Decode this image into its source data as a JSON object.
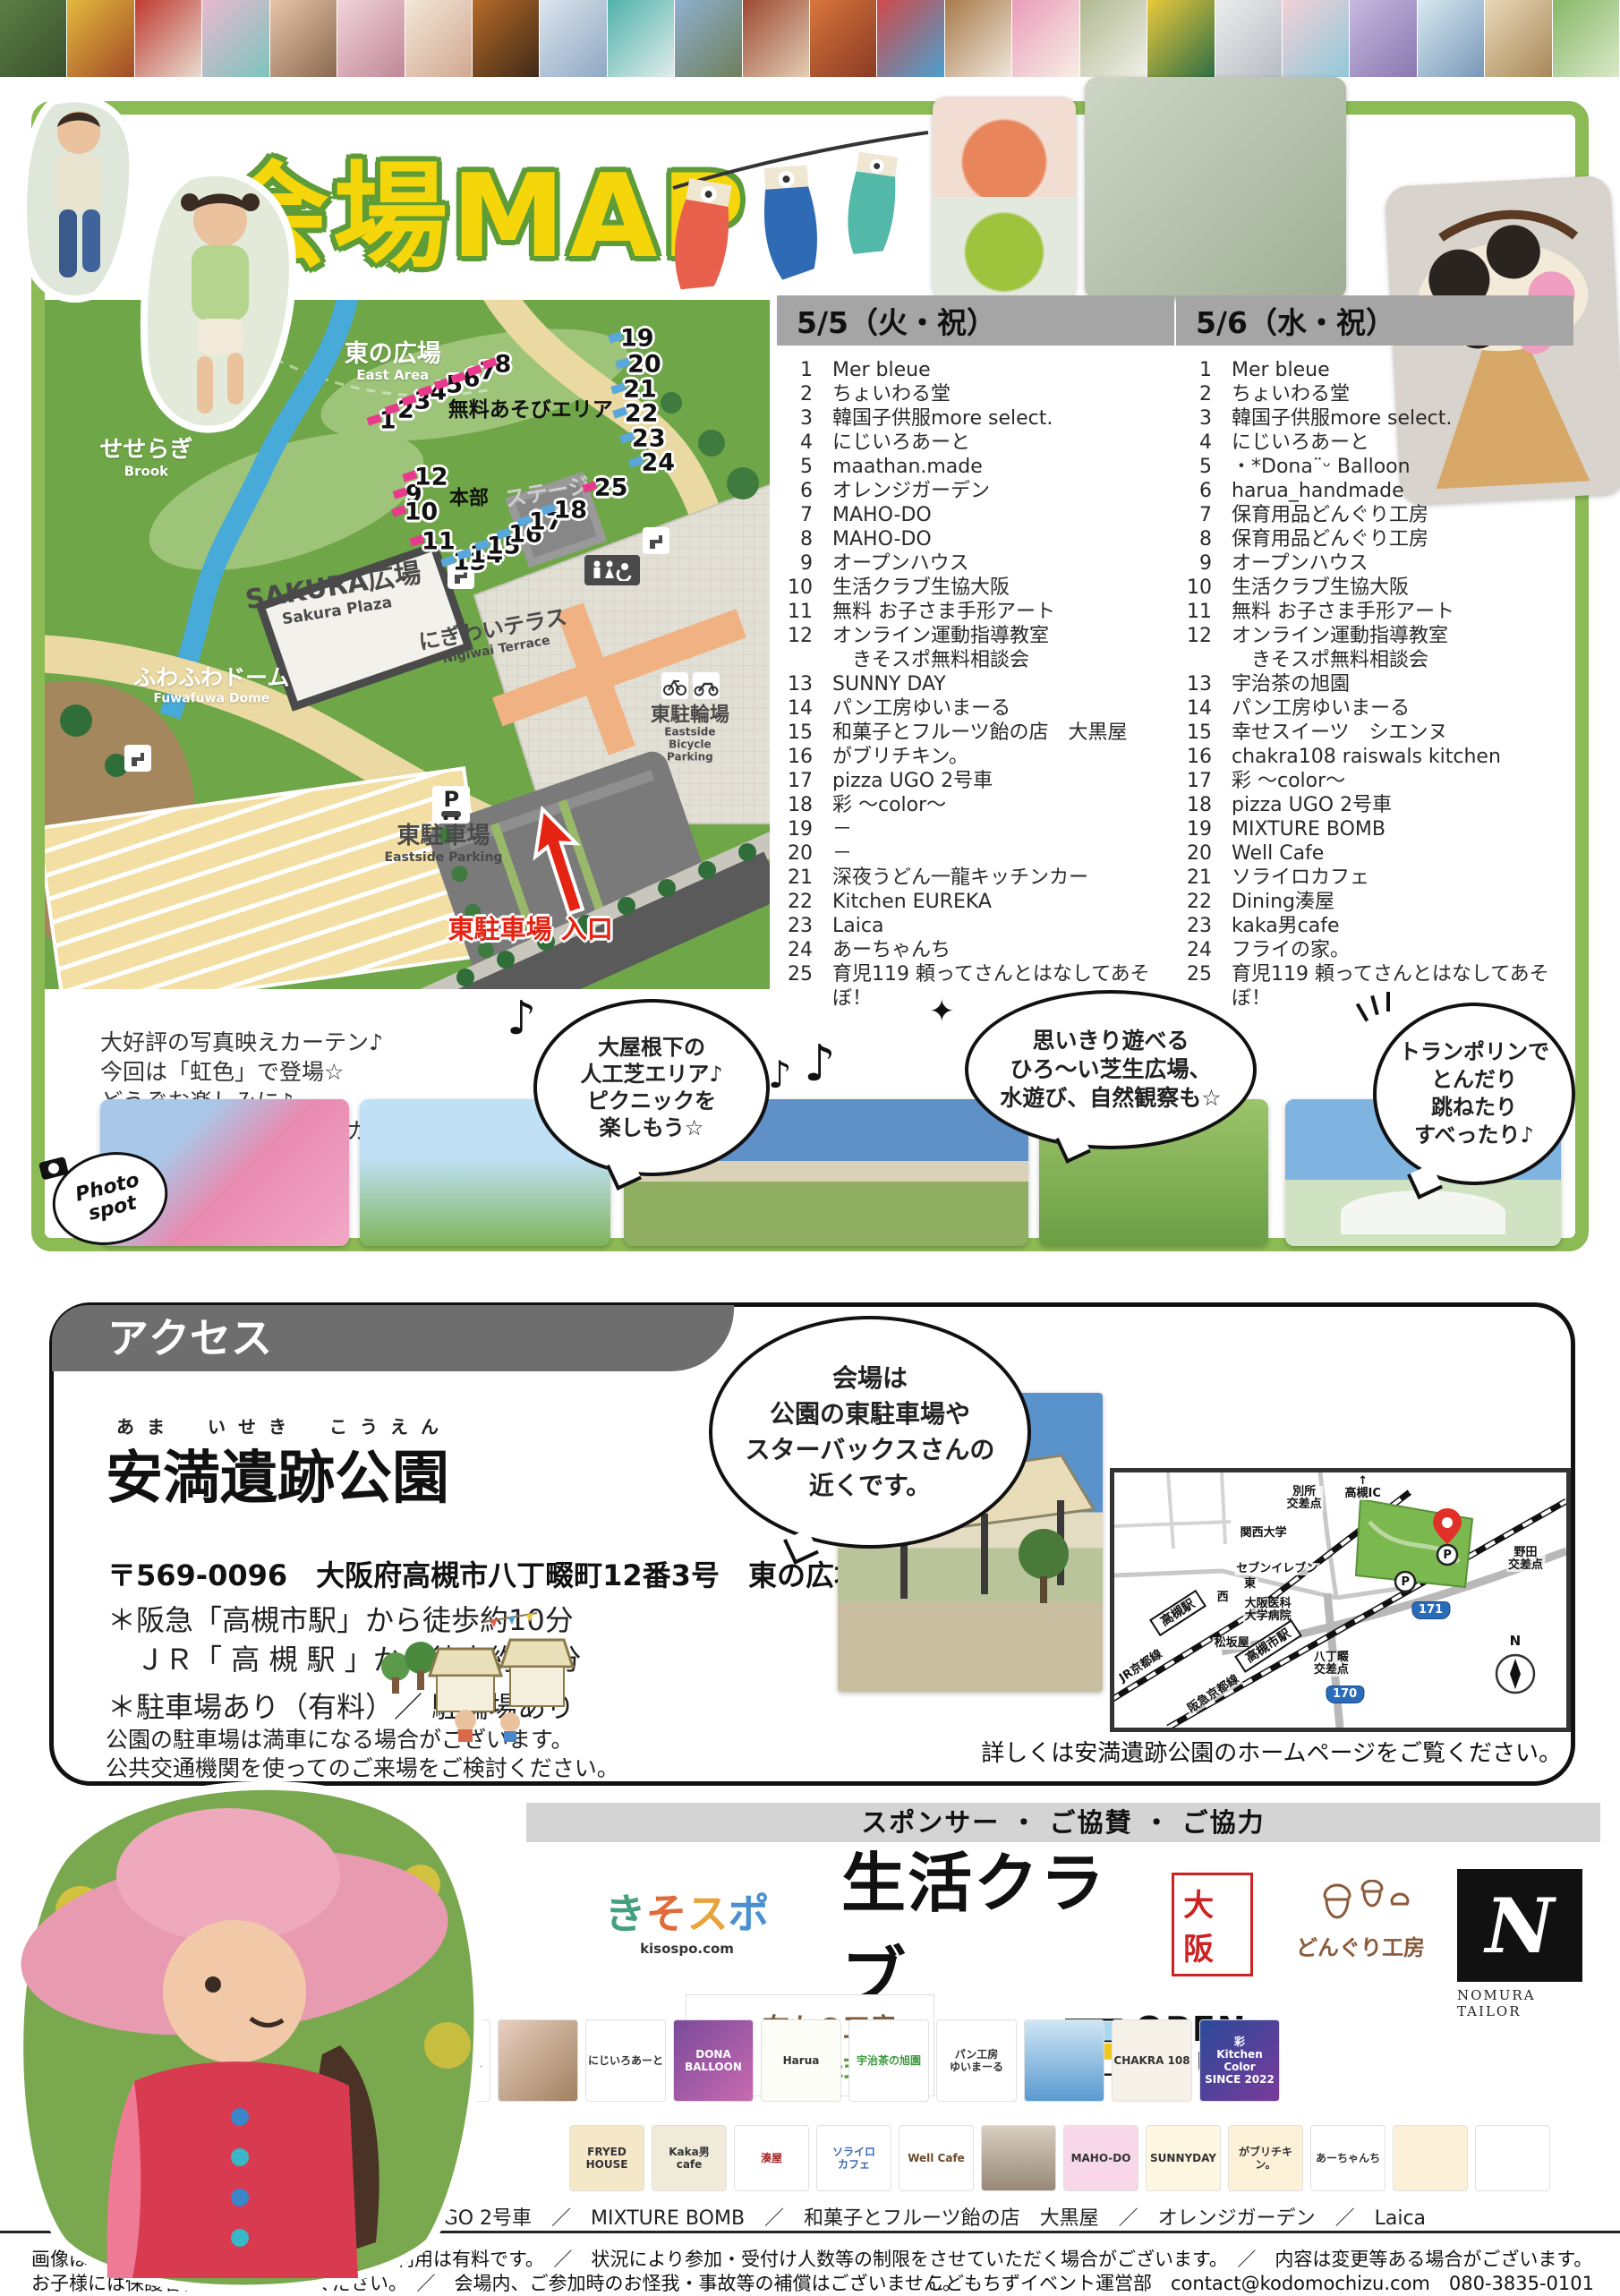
{
  "page": {
    "title": "会場MAP"
  },
  "top_strip": {
    "tiles": [
      {
        "c1": "#5d7f45",
        "c2": "#39512d"
      },
      {
        "c1": "#e3b93c",
        "c2": "#a14a28"
      },
      {
        "c1": "#c03a32",
        "c2": "#e8ddd0"
      },
      {
        "c1": "#e9b9cf",
        "c2": "#7cc4bd"
      },
      {
        "c1": "#e7c4a8",
        "c2": "#8a6a50"
      },
      {
        "c1": "#f2d3da",
        "c2": "#c08898"
      },
      {
        "c1": "#f3e6d8",
        "c2": "#d0a890"
      },
      {
        "c1": "#b56a28",
        "c2": "#402a18"
      },
      {
        "c1": "#dce4ec",
        "c2": "#8fa8c4"
      },
      {
        "c1": "#50b2a8",
        "c2": "#e0ecec"
      },
      {
        "c1": "#8fb0d0",
        "c2": "#6e7f5a"
      },
      {
        "c1": "#9e4a34",
        "c2": "#e3cdb4"
      },
      {
        "c1": "#d9763c",
        "c2": "#8a3a24"
      },
      {
        "c1": "#cf4a4a",
        "c2": "#4aa0cf"
      },
      {
        "c1": "#a87a4a",
        "c2": "#efe6da"
      },
      {
        "c1": "#ea9cba",
        "c2": "#f7efe6"
      },
      {
        "c1": "#b0b890",
        "c2": "#f0f0e8"
      },
      {
        "c1": "#e9c93c",
        "c2": "#2f6e45"
      },
      {
        "c1": "#ececec",
        "c2": "#b8bcc4"
      },
      {
        "c1": "#f2d0d8",
        "c2": "#90c8d8"
      },
      {
        "c1": "#c8b8e0",
        "c2": "#8878b0"
      },
      {
        "c1": "#d8e8f0",
        "c2": "#7898b8"
      },
      {
        "c1": "#e8d8b8",
        "c2": "#a88858"
      },
      {
        "c1": "#88b868",
        "c2": "#d8e8c8"
      }
    ]
  },
  "map": {
    "labels": {
      "east_plaza": {
        "jp": "東の広場",
        "en": "East Area"
      },
      "free_play": "無料あそびエリア",
      "brook": {
        "jp": "せせらぎ",
        "en": "Brook"
      },
      "sakura": {
        "jp": "SAKURA広場",
        "en": "Sakura Plaza"
      },
      "fuwafuwa": {
        "jp": "ふわふわドーム",
        "en": "Fuwafuwa Dome"
      },
      "nigiwai": {
        "jp": "にぎわいテラス",
        "en": "Nigiwai Terrace"
      },
      "bicycle": {
        "jp": "東駐輪場",
        "en": "Eastside\nBicycle Parking"
      },
      "parking": {
        "jp": "東駐車場",
        "en": "Eastside Parking"
      },
      "stage": {
        "jp": "ステージ",
        "en": "Stage"
      },
      "honbu": "本部",
      "entrance": "東駐車場 入口",
      "p": "P"
    },
    "markers": [
      {
        "n": "1",
        "x": 47.3,
        "y": 17.5,
        "c": "p"
      },
      {
        "n": "2",
        "x": 49.8,
        "y": 16.0,
        "c": "p"
      },
      {
        "n": "3",
        "x": 52.1,
        "y": 14.7,
        "c": "p"
      },
      {
        "n": "4",
        "x": 54.3,
        "y": 13.4,
        "c": "p"
      },
      {
        "n": "5",
        "x": 56.5,
        "y": 12.3,
        "c": "p"
      },
      {
        "n": "6",
        "x": 58.9,
        "y": 11.4,
        "c": "p"
      },
      {
        "n": "7",
        "x": 61.1,
        "y": 10.4,
        "c": "p"
      },
      {
        "n": "8",
        "x": 63.2,
        "y": 9.4,
        "c": "p"
      },
      {
        "n": "9",
        "x": 50.9,
        "y": 28.2,
        "c": "p"
      },
      {
        "n": "10",
        "x": 51.9,
        "y": 30.8,
        "c": "p"
      },
      {
        "n": "11",
        "x": 54.3,
        "y": 35.1,
        "c": "p"
      },
      {
        "n": "12",
        "x": 53.3,
        "y": 25.7,
        "c": "p"
      },
      {
        "n": "13",
        "x": 58.6,
        "y": 38.1,
        "c": "b"
      },
      {
        "n": "14",
        "x": 60.9,
        "y": 37.0,
        "c": "b"
      },
      {
        "n": "15",
        "x": 63.3,
        "y": 35.7,
        "c": "b"
      },
      {
        "n": "16",
        "x": 66.3,
        "y": 34.0,
        "c": "b"
      },
      {
        "n": "17",
        "x": 69.1,
        "y": 32.2,
        "c": "b"
      },
      {
        "n": "18",
        "x": 72.5,
        "y": 30.5,
        "c": "b"
      },
      {
        "n": "19",
        "x": 81.7,
        "y": 5.6,
        "c": "b"
      },
      {
        "n": "20",
        "x": 82.7,
        "y": 9.4,
        "c": "b"
      },
      {
        "n": "21",
        "x": 82.1,
        "y": 13.0,
        "c": "b"
      },
      {
        "n": "22",
        "x": 82.3,
        "y": 16.5,
        "c": "b"
      },
      {
        "n": "23",
        "x": 83.3,
        "y": 20.1,
        "c": "b"
      },
      {
        "n": "24",
        "x": 84.6,
        "y": 23.6,
        "c": "b"
      },
      {
        "n": "25",
        "x": 78.1,
        "y": 27.3,
        "c": "p"
      }
    ]
  },
  "lists": {
    "day1": {
      "header": "5/5（火・祝）",
      "items": [
        {
          "n": "1",
          "label": "Mer bleue"
        },
        {
          "n": "2",
          "label": "ちょいわる堂"
        },
        {
          "n": "3",
          "label": "韓国子供服more select."
        },
        {
          "n": "4",
          "label": "にじいろあーと"
        },
        {
          "n": "5",
          "label": "maathan.made"
        },
        {
          "n": "6",
          "label": "オレンジガーデン"
        },
        {
          "n": "7",
          "label": "MAHO-DO"
        },
        {
          "n": "8",
          "label": "MAHO-DO"
        },
        {
          "n": "9",
          "label": "オープンハウス"
        },
        {
          "n": "10",
          "label": "生活クラブ生協大阪"
        },
        {
          "n": "11",
          "label": "無料 お子さま手形アート"
        },
        {
          "n": "12",
          "label": "オンライン運動指導教室\n　きそスポ無料相談会"
        },
        {
          "n": "13",
          "label": "SUNNY DAY"
        },
        {
          "n": "14",
          "label": "パン工房ゆいまーる"
        },
        {
          "n": "15",
          "label": "和菓子とフルーツ飴の店　大黒屋"
        },
        {
          "n": "16",
          "label": "がブリチキン。"
        },
        {
          "n": "17",
          "label": "pizza UGO 2号車"
        },
        {
          "n": "18",
          "label": "彩 〜color〜"
        },
        {
          "n": "19",
          "label": "－"
        },
        {
          "n": "20",
          "label": "－"
        },
        {
          "n": "21",
          "label": "深夜うどん一龍キッチンカー"
        },
        {
          "n": "22",
          "label": "Kitchen EUREKA"
        },
        {
          "n": "23",
          "label": "Laica"
        },
        {
          "n": "24",
          "label": "あーちゃんち"
        },
        {
          "n": "25",
          "label": "育児119 頼ってさんとはなしてあそぼ！"
        }
      ]
    },
    "day2": {
      "header": "5/6（水・祝）",
      "items": [
        {
          "n": "1",
          "label": "Mer bleue"
        },
        {
          "n": "2",
          "label": "ちょいわる堂"
        },
        {
          "n": "3",
          "label": "韓国子供服more select."
        },
        {
          "n": "4",
          "label": "にじいろあーと"
        },
        {
          "n": "5",
          "label": "・*Dona¨ᵕ Balloon"
        },
        {
          "n": "6",
          "label": "harua_handmade"
        },
        {
          "n": "7",
          "label": "保育用品どんぐり工房"
        },
        {
          "n": "8",
          "label": "保育用品どんぐり工房"
        },
        {
          "n": "9",
          "label": "オープンハウス"
        },
        {
          "n": "10",
          "label": "生活クラブ生協大阪"
        },
        {
          "n": "11",
          "label": "無料 お子さま手形アート"
        },
        {
          "n": "12",
          "label": "オンライン運動指導教室\n　きそスポ無料相談会"
        },
        {
          "n": "13",
          "label": "宇治茶の旭園"
        },
        {
          "n": "14",
          "label": "パン工房ゆいまーる"
        },
        {
          "n": "15",
          "label": "幸せスイーツ　シエンヌ"
        },
        {
          "n": "16",
          "label": "chakra108 raiswals kitchen"
        },
        {
          "n": "17",
          "label": "彩 〜color〜"
        },
        {
          "n": "18",
          "label": "pizza UGO 2号車"
        },
        {
          "n": "19",
          "label": "MIXTURE BOMB"
        },
        {
          "n": "20",
          "label": "Well Cafe"
        },
        {
          "n": "21",
          "label": "ソライロカフェ"
        },
        {
          "n": "22",
          "label": "Dining湊屋"
        },
        {
          "n": "23",
          "label": "kaka男cafe"
        },
        {
          "n": "24",
          "label": "フライの家。"
        },
        {
          "n": "25",
          "label": "育児119 頼ってさんとはなしてあそぼ！"
        }
      ]
    }
  },
  "curtain_note": "大好評の写真映えカーテン♪\n今回は「虹色」で登場☆\nどうぞお楽しみに♪\n（写真は前回のいちご色カーテン）",
  "bubbles": {
    "b1": "大屋根下の\n人工芝エリア♪\nピクニックを\n楽しもう☆",
    "b2": "思いきり遊べる\nひろ〜い芝生広場、\n水遊び、自然観察も☆",
    "b3": "トランポリンで\nとんだり\n跳ねたり\nすべったり♪",
    "note1": "♪",
    "note2": "♪",
    "note3": "♪",
    "sparkle": "✦"
  },
  "photo_spot": {
    "line1": "Photo",
    "line2": "spot"
  },
  "access": {
    "header": "アクセス",
    "furigana": "あま　いせき　こうえん",
    "park_name": "安満遺跡公園",
    "address": "〒569-0096　大阪府高槻市八丁畷町12番3号　東の広場",
    "walk": "＊阪急「高槻市駅」から徒歩約10分\n　ＪＲ「 高 槻 駅 」から徒歩約13分",
    "parking": "＊駐車場あり（有料）／ 駐輪場あり",
    "note": "公園の駐車場は満車になる場合がございます。\n公共交通機関を使ってのご来場をご検討ください。",
    "bubble": "会場は\n公園の東駐車場や\nスターバックスさんの\n近くです。",
    "minimap_note": "詳しくは安満遺跡公園のホームページをご覧ください。"
  },
  "minimap": {
    "p": "P",
    "compass": "N",
    "labels": [
      {
        "t": "別所\n交差点",
        "x": 42,
        "y": 10
      },
      {
        "t": "↑\n高槻IC",
        "x": 55,
        "y": 6
      },
      {
        "t": "関西大学",
        "x": 33,
        "y": 24
      },
      {
        "t": "セブンイレブン",
        "x": 36,
        "y": 38
      },
      {
        "t": "大阪医科\n大学病院",
        "x": 34,
        "y": 54
      },
      {
        "t": "松坂屋",
        "x": 26,
        "y": 67
      },
      {
        "t": "高槻駅",
        "x": 14,
        "y": 55,
        "r": -33,
        "cls": "boxed"
      },
      {
        "t": "JR京都線",
        "x": 6,
        "y": 76,
        "r": -33
      },
      {
        "t": "高槻市駅",
        "x": 34,
        "y": 68,
        "r": -33,
        "cls": "boxed"
      },
      {
        "t": "阪急京都線",
        "x": 22,
        "y": 87,
        "r": -33
      },
      {
        "t": "八丁畷\n交差点",
        "x": 48,
        "y": 75
      },
      {
        "t": "野田\n交差点",
        "x": 91,
        "y": 34
      },
      {
        "t": "西",
        "x": 24,
        "y": 49
      },
      {
        "t": "東",
        "x": 30,
        "y": 44
      },
      {
        "t": "171",
        "x": 70,
        "y": 54,
        "cls": "shield"
      },
      {
        "t": "170",
        "x": 51,
        "y": 87,
        "cls": "shield"
      }
    ]
  },
  "sponsors": {
    "bar": "スポンサー ・ ご協賛 ・ ご協力",
    "kisospo": {
      "c1": "き",
      "c2": "そ",
      "c3": "ス",
      "c4": "ポ",
      "url": "kisospo.com"
    },
    "seikatsu": {
      "text": "生活クラブ",
      "badge": "大阪"
    },
    "donguri": "どんぐり工房",
    "nomura": {
      "initial": "N",
      "caption": "NOMURA TAILOR"
    },
    "nunomono": {
      "line1": "布もの工房",
      "line2": "北次株式会社"
    },
    "openhouse": {
      "line1": "OPEN",
      "line2": "HOUSE"
    },
    "row1": [
      {
        "label": "シーグラス\nアクセサリー",
        "bg": "#ffffff"
      },
      {
        "label": "",
        "bg": "linear-gradient(135deg,#e8d0c0,#a08060)"
      },
      {
        "label": "にじいろあーと",
        "bg": "#ffffff"
      },
      {
        "label": "DONA\nBALLOON",
        "bg": "linear-gradient(135deg,#7a4a9a,#c86ab0)",
        "fg": "#ffffff"
      },
      {
        "label": "Harua",
        "bg": "#fdfdf8"
      },
      {
        "label": "宇治茶の旭園",
        "bg": "#ffffff",
        "fg": "#3a9a3a"
      },
      {
        "label": "パン工房\nゆいまーる",
        "bg": "#ffffff"
      },
      {
        "label": "",
        "bg": "linear-gradient(#cfe6f5,#5a9ad0)"
      },
      {
        "label": "CHAKRA 108",
        "bg": "#f5f0e8"
      },
      {
        "label": "彩\nKitchen Color\nSINCE 2022",
        "bg": "linear-gradient(135deg,#2a4a9a,#7a3a9a)",
        "fg": "#ffffff"
      }
    ],
    "row2": [
      {
        "label": "FRYED\nHOUSE",
        "bg": "#f5e8c8"
      },
      {
        "label": "Kaka男\ncafe",
        "bg": "#f0ead8"
      },
      {
        "label": "湊屋",
        "bg": "#ffffff",
        "fg": "#a02a2a"
      },
      {
        "label": "ソライロ\nカフェ",
        "bg": "#ffffff",
        "fg": "#3a6ab8"
      },
      {
        "label": "Well Cafe",
        "bg": "#ffffff",
        "fg": "#6a4a2a"
      },
      {
        "label": "",
        "bg": "linear-gradient(#d8cec0,#988878)"
      },
      {
        "label": "MAHO-DO",
        "bg": "#f8d8e8"
      },
      {
        "label": "SUNNYDAY",
        "bg": "#fdf6e0"
      },
      {
        "label": "がブリチキン。",
        "bg": "#fdf2d8"
      },
      {
        "label": "あーちゃんち",
        "bg": "#ffffff"
      },
      {
        "label": "",
        "bg": "#fdf0d8"
      },
      {
        "label": "",
        "bg": "#ffffff"
      }
    ],
    "names": "ちょいわる堂　／　pizza UGO 2号車　／　MIXTURE BOMB　／　和菓子とフルーツ飴の店　大黒屋　／　オレンジガーデン　／　Laica"
  },
  "footer": {
    "line1": "画像はイメージです。　／　マルシェ等のご利用は有料です。　／　状況により参加・受付け人数等の制限をさせていただく場合がございます。　／　内容は変更等ある場合がございます。",
    "line2": "お子様には保護者様がお付き添いください。　／　会場内、ご参加時のお怪我・事故等の補償はございません。",
    "contact": "こどもちずイベント運営部　contact@kodomochizu.com　080-3835-0101"
  }
}
